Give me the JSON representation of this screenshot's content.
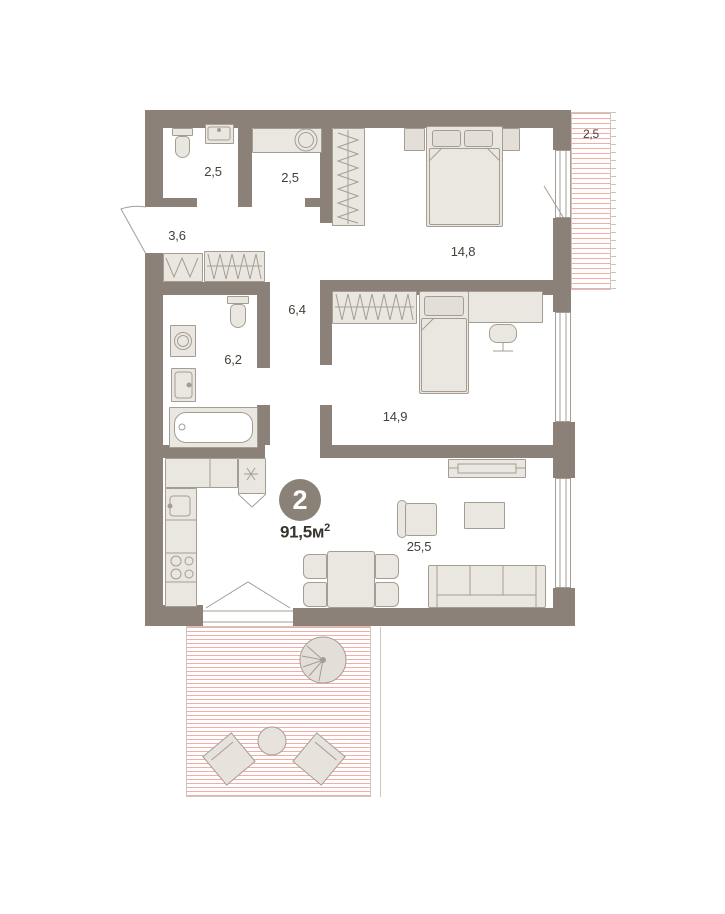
{
  "plan": {
    "badge": {
      "rooms_count": "2",
      "area_value": "91,5",
      "area_unit": "м",
      "area_unit_sup": "2"
    },
    "rooms": [
      {
        "id": "wc",
        "area_label": "2,5"
      },
      {
        "id": "laundry",
        "area_label": "2,5"
      },
      {
        "id": "hallway",
        "area_label": "3,6"
      },
      {
        "id": "bedroom-1",
        "area_label": "14,8"
      },
      {
        "id": "balcony",
        "area_label": "2,5"
      },
      {
        "id": "corridor",
        "area_label": "6,4"
      },
      {
        "id": "bathroom",
        "area_label": "6,2"
      },
      {
        "id": "bedroom-2",
        "area_label": "14,9"
      },
      {
        "id": "living-kitchen",
        "area_label": "25,5"
      }
    ],
    "colors": {
      "wall": "#8b8179",
      "hatch_line": "#f2aea6",
      "furniture_fill": "#eae7e1",
      "furniture_border": "#a59d94",
      "label_text": "#454139",
      "badge_bg": "#8a8177",
      "badge_text": "#ffffff"
    }
  }
}
